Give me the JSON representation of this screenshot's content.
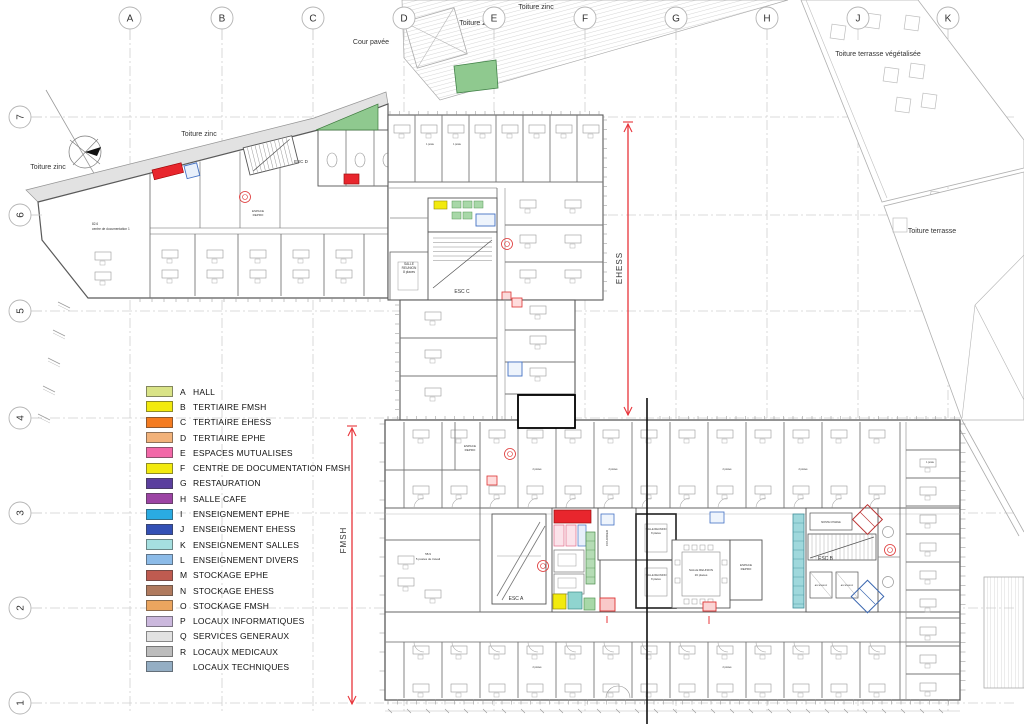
{
  "title": "Plan d'étage EHESS / FMSH",
  "colors": {
    "wall": "#5a5a5a",
    "grid": "#cfcfcf",
    "arrow_red": "#e8343a",
    "highlight_red": "#e8262d",
    "green_roof": "#8fc98f",
    "green_room": "#a8d8a8",
    "cyan_room": "#9fd8dc",
    "yellow_room": "#f2ea0e",
    "blue_equip": "#4472c4"
  },
  "grid": {
    "columns": [
      {
        "label": "A",
        "x": 130
      },
      {
        "label": "B",
        "x": 222
      },
      {
        "label": "C",
        "x": 313
      },
      {
        "label": "D",
        "x": 404
      },
      {
        "label": "E",
        "x": 494
      },
      {
        "label": "F",
        "x": 585
      },
      {
        "label": "G",
        "x": 676
      },
      {
        "label": "H",
        "x": 767
      },
      {
        "label": "J",
        "x": 858
      },
      {
        "label": "K",
        "x": 948
      }
    ],
    "rows": [
      {
        "label": "7",
        "y": 117
      },
      {
        "label": "6",
        "y": 215
      },
      {
        "label": "5",
        "y": 311
      },
      {
        "label": "4",
        "y": 418
      },
      {
        "label": "3",
        "y": 513
      },
      {
        "label": "2",
        "y": 608
      },
      {
        "label": "1",
        "y": 703
      }
    ]
  },
  "legend": {
    "items": [
      {
        "letter": "A",
        "label": "HALL",
        "color": "#d9e387"
      },
      {
        "letter": "B",
        "label": "TERTIAIRE FMSH",
        "color": "#f2ea0e"
      },
      {
        "letter": "C",
        "label": "TERTIAIRE EHESS",
        "color": "#f47b20"
      },
      {
        "letter": "D",
        "label": "TERTIAIRE EPHE",
        "color": "#f2b27a"
      },
      {
        "letter": "E",
        "label": "ESPACES MUTUALISES",
        "color": "#f268a8"
      },
      {
        "letter": "F",
        "label": "CENTRE DE DOCUMENTATION FMSH",
        "color": "#f2ea0e"
      },
      {
        "letter": "G",
        "label": "RESTAURATION",
        "color": "#5b3f9e"
      },
      {
        "letter": "H",
        "label": "SALLE CAFE",
        "color": "#9c44a4"
      },
      {
        "letter": "I",
        "label": "ENSEIGNEMENT EPHE",
        "color": "#2aabe2"
      },
      {
        "letter": "J",
        "label": "ENSEIGNEMENT EHESS",
        "color": "#3350b5"
      },
      {
        "letter": "K",
        "label": "ENSEIGNEMENT SALLES",
        "color": "#a5dfe0"
      },
      {
        "letter": "L",
        "label": "ENSEIGNEMENT DIVERS",
        "color": "#8cbbe8"
      },
      {
        "letter": "M",
        "label": "STOCKAGE EPHE",
        "color": "#bf5b50"
      },
      {
        "letter": "N",
        "label": "STOCKAGE EHESS",
        "color": "#b07a5e"
      },
      {
        "letter": "O",
        "label": "STOCKAGE FMSH",
        "color": "#eba55f"
      },
      {
        "letter": "P",
        "label": "LOCAUX INFORMATIQUES",
        "color": "#cbb8dd"
      },
      {
        "letter": "Q",
        "label": "SERVICES GENERAUX",
        "color": "#e2e2e2"
      },
      {
        "letter": "R",
        "label": "LOCAUX MEDICAUX",
        "color": "#bcbcbc"
      },
      {
        "letter": "",
        "label": "LOCAUX TECHNIQUES",
        "color": "#94aec4"
      }
    ]
  },
  "arrows": [
    {
      "label": "EHESS",
      "x": 628,
      "y1": 122,
      "y2": 417,
      "label_y": 268
    },
    {
      "label": "FMSH",
      "x": 352,
      "y1": 426,
      "y2": 706,
      "label_y": 540
    }
  ],
  "stamps": [
    [
      245,
      197
    ],
    [
      507,
      244
    ],
    [
      510,
      454
    ],
    [
      543,
      566
    ],
    [
      890,
      550
    ]
  ],
  "annotations": [
    {
      "text": "Toiture zinc",
      "x": 536,
      "y": 9,
      "size": 7
    },
    {
      "text": "Toiture zinc",
      "x": 477,
      "y": 25,
      "size": 7
    },
    {
      "text": "Cour pavée",
      "x": 371,
      "y": 44,
      "size": 7
    },
    {
      "text": "Toiture terrasse végétalisée",
      "x": 878,
      "y": 56,
      "size": 7
    },
    {
      "text": "Toiture zinc",
      "x": 199,
      "y": 136,
      "size": 7
    },
    {
      "text": "Toiture zinc",
      "x": 48,
      "y": 169,
      "size": 7
    },
    {
      "text": "Toiture terrasse",
      "x": 932,
      "y": 233,
      "size": 7
    },
    {
      "text": "ESC D",
      "x": 301,
      "y": 163,
      "size": 4.5
    },
    {
      "text": "ESC C",
      "x": 462,
      "y": 293,
      "size": 5
    },
    {
      "text": "ESC A",
      "x": 516,
      "y": 600,
      "size": 5
    },
    {
      "text": "ESC B",
      "x": 818,
      "y": 560,
      "size": 5,
      "anchor": "start"
    },
    {
      "text": "SALLE",
      "x": 409,
      "y": 265,
      "size": 3.2
    },
    {
      "text": "REUNION",
      "x": 409,
      "y": 269,
      "size": 3.2
    },
    {
      "text": "8 places",
      "x": 409,
      "y": 273,
      "size": 3.2
    },
    {
      "text": "SALLE REUNION",
      "x": 656,
      "y": 530,
      "size": 2.6
    },
    {
      "text": "8 places",
      "x": 656,
      "y": 534,
      "size": 2.6
    },
    {
      "text": "SALLE REUNION",
      "x": 656,
      "y": 576,
      "size": 2.6
    },
    {
      "text": "8 places",
      "x": 656,
      "y": 580,
      "size": 2.6
    },
    {
      "text": "SALLE REUNION",
      "x": 701,
      "y": 571,
      "size": 3
    },
    {
      "text": "16 places",
      "x": 701,
      "y": 576,
      "size": 3
    },
    {
      "text": "ESPACE",
      "x": 470,
      "y": 447,
      "size": 3
    },
    {
      "text": "REPRO",
      "x": 470,
      "y": 451,
      "size": 3
    },
    {
      "text": "ESPACE",
      "x": 746,
      "y": 566,
      "size": 3
    },
    {
      "text": "REPRO",
      "x": 746,
      "y": 570,
      "size": 3
    },
    {
      "text": "ESPACE",
      "x": 258,
      "y": 212,
      "size": 3
    },
    {
      "text": "REPRO",
      "x": 258,
      "y": 216,
      "size": 3
    },
    {
      "text": "COURRIER",
      "x": 608,
      "y": 538,
      "size": 3,
      "rotate": -90
    },
    {
      "text": "82.6",
      "x": 92,
      "y": 225,
      "size": 3.2,
      "anchor": "start"
    },
    {
      "text": "centre de documentation 1",
      "x": 92,
      "y": 230,
      "size": 3.2,
      "anchor": "start"
    },
    {
      "text": "58.9",
      "x": 428,
      "y": 555,
      "size": 3
    },
    {
      "text": "5 postes de travail",
      "x": 428,
      "y": 560,
      "size": 3
    },
    {
      "text": "MONTE CHARGE",
      "x": 831,
      "y": 523,
      "size": 2.4
    },
    {
      "text": "ASCENSEUR",
      "x": 821,
      "y": 586,
      "size": 2
    },
    {
      "text": "ASCENSEUR",
      "x": 847,
      "y": 586,
      "size": 2
    },
    {
      "text": "2 postes",
      "x": 537,
      "y": 470,
      "size": 2.4
    },
    {
      "text": "2 postes",
      "x": 613,
      "y": 470,
      "size": 2.4
    },
    {
      "text": "2 postes",
      "x": 727,
      "y": 470,
      "size": 2.4
    },
    {
      "text": "2 postes",
      "x": 803,
      "y": 470,
      "size": 2.4
    },
    {
      "text": "2 postes",
      "x": 537,
      "y": 668,
      "size": 2.4
    },
    {
      "text": "2 postes",
      "x": 727,
      "y": 668,
      "size": 2.4
    },
    {
      "text": "1 poste",
      "x": 430,
      "y": 145,
      "size": 2.4
    },
    {
      "text": "1 poste",
      "x": 457,
      "y": 145,
      "size": 2.4
    },
    {
      "text": "1 poste",
      "x": 930,
      "y": 463,
      "size": 2.4
    }
  ]
}
